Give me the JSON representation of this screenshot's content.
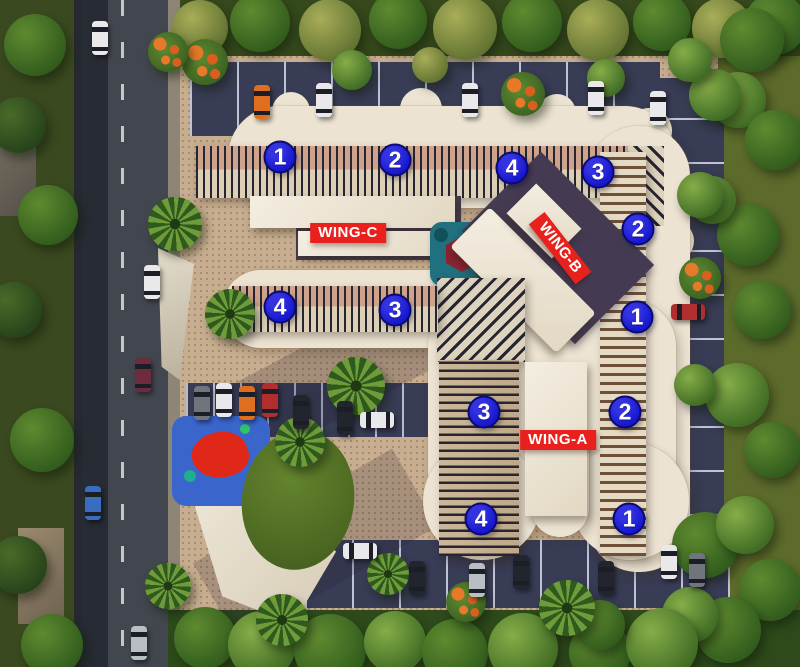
{
  "scene": {
    "type": "aerial-site-plan",
    "title": "Residential complex layout with numbered units"
  },
  "wings": [
    {
      "id": "wing-c",
      "label": "WING-C",
      "x": 348,
      "y": 233,
      "rotation": 0
    },
    {
      "id": "wing-b",
      "label": "WING-B",
      "x": 560,
      "y": 248,
      "rotation": 52
    },
    {
      "id": "wing-a",
      "label": "WING-A",
      "x": 558,
      "y": 440,
      "rotation": 0
    }
  ],
  "markers": [
    {
      "label": "1",
      "x": 280,
      "y": 157
    },
    {
      "label": "2",
      "x": 395,
      "y": 160
    },
    {
      "label": "4",
      "x": 512,
      "y": 168
    },
    {
      "label": "3",
      "x": 598,
      "y": 172
    },
    {
      "label": "2",
      "x": 638,
      "y": 229
    },
    {
      "label": "1",
      "x": 637,
      "y": 317
    },
    {
      "label": "4",
      "x": 280,
      "y": 307
    },
    {
      "label": "3",
      "x": 395,
      "y": 310
    },
    {
      "label": "3",
      "x": 484,
      "y": 412
    },
    {
      "label": "2",
      "x": 625,
      "y": 412
    },
    {
      "label": "4",
      "x": 481,
      "y": 519
    },
    {
      "label": "1",
      "x": 629,
      "y": 519
    }
  ],
  "colors": {
    "marker_bg": "#1717cf",
    "marker_border": "#0a0a70",
    "marker_text": "#ffffff",
    "wing_bg": "#e8211c",
    "wing_text": "#ffffff"
  }
}
